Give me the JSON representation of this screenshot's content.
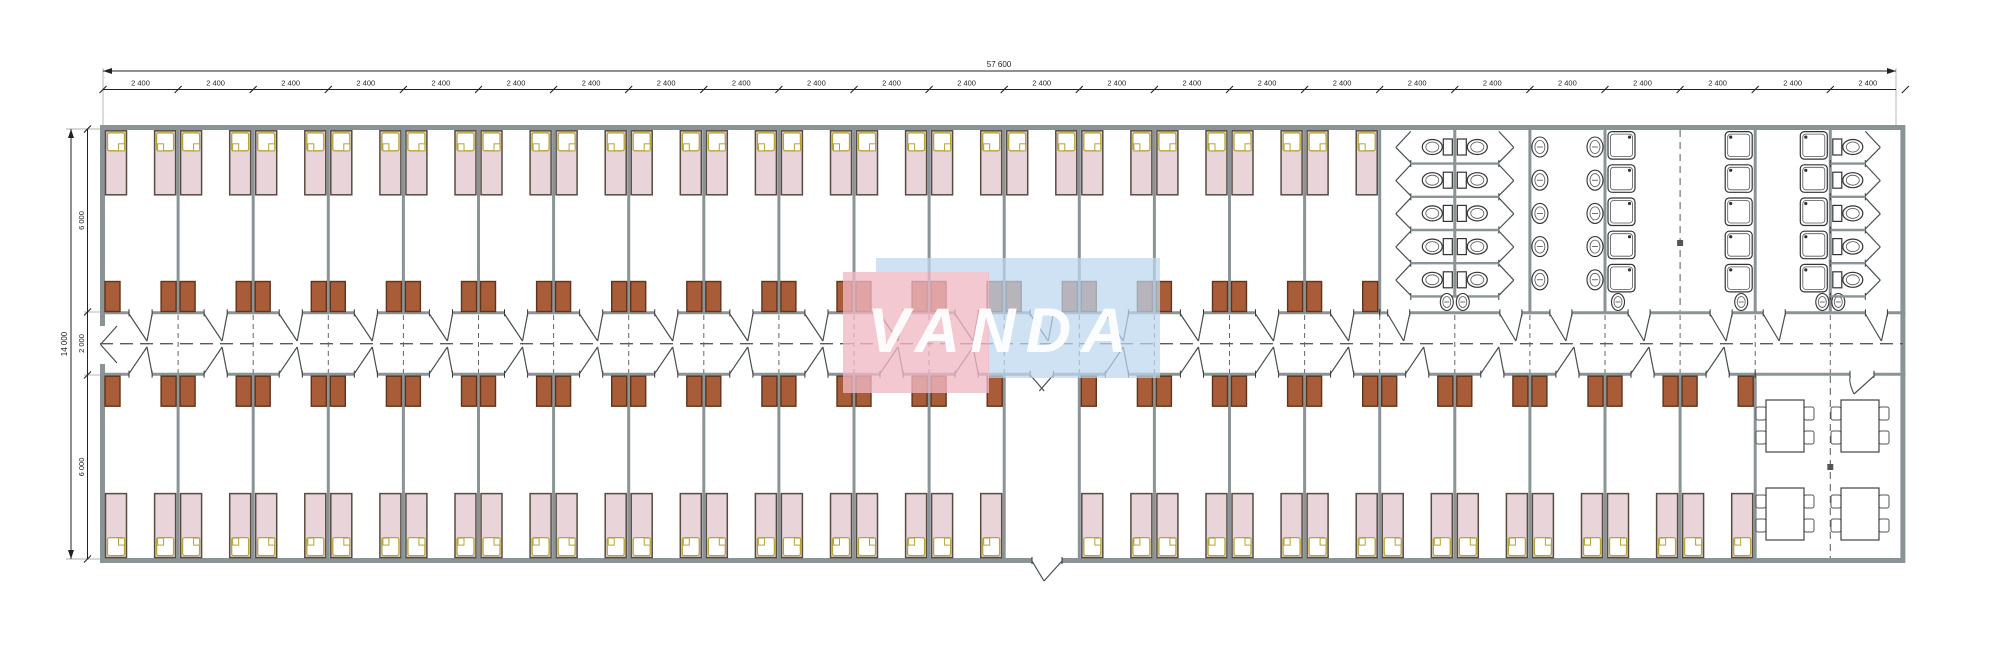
{
  "watermark": {
    "text": "VANDA",
    "pink": "#f0b9c4",
    "blue": "#bcd7f0"
  },
  "dimensions": {
    "overall_width_label": "57 600",
    "segment_count": 24,
    "segment_label": "2 400",
    "overall_height_label": "14 000",
    "height_segment_labels": [
      "6 000",
      "2 000",
      "6 000"
    ]
  },
  "layout": {
    "module_count": 24,
    "top_room_count": 17,
    "bottom_room_count": 22,
    "vestibule_module": 12,
    "beds_total": 76,
    "wardrobes_total": 76
  },
  "sanitary": {
    "wc_stalls_double_room": 10,
    "wc_stalls_right_room": 5,
    "washroom_basins": 10,
    "showers": 15,
    "corner_basins": 8
  },
  "dining": {
    "tables": 4,
    "chairs_per_table": 4
  },
  "colors": {
    "wall": "#8a9396",
    "wall_dark": "#474f52",
    "bed_fill": "#e9d4d9",
    "bed_stroke": "#564c42",
    "pillow_stroke": "#b5a437",
    "wardrobe_fill": "#a85c37",
    "wardrobe_stroke": "#5f341b",
    "fixture_stroke": "#333333",
    "dash": "#666666",
    "dim": "#222222",
    "white": "#ffffff"
  }
}
